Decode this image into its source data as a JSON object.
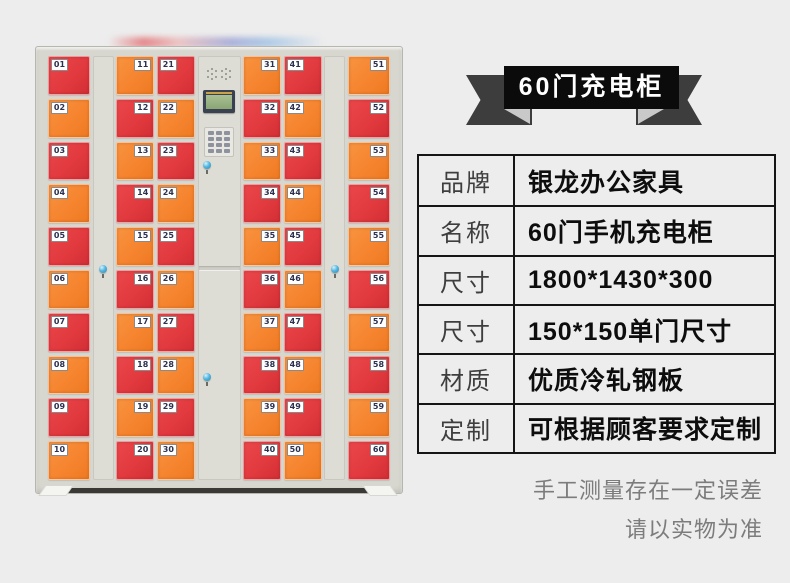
{
  "banner": {
    "title": "60门充电柜",
    "bg_color": "#0b0b0b",
    "ribbon_color": "#3d3d3d",
    "text_color": "#ffffff"
  },
  "spec_table": {
    "rows": [
      {
        "label": "品牌",
        "value": "银龙办公家具"
      },
      {
        "label": "名称",
        "value": "60门手机充电柜"
      },
      {
        "label": "尺寸",
        "value": "1800*1430*300"
      },
      {
        "label": "尺寸",
        "value": "150*150单门尺寸"
      },
      {
        "label": "材质",
        "value": "优质冷轧钢板"
      },
      {
        "label": "定制",
        "value": "可根据顾客要求定制"
      }
    ]
  },
  "disclaimer": {
    "line1": "手工测量存在一定误差",
    "line2": "请以实物为准"
  },
  "cabinet": {
    "door_colors": {
      "red": "#e23a3e",
      "orange": "#f6842f"
    },
    "frame_color": "#d8d7cf",
    "control_panel_features": [
      "speaker-grille",
      "lcd-screen",
      "keypad",
      "lock"
    ],
    "columns": [
      {
        "type": "doors",
        "label_side": "left",
        "doors": [
          {
            "num": "01",
            "color": "red"
          },
          {
            "num": "02",
            "color": "orange"
          },
          {
            "num": "03",
            "color": "red"
          },
          {
            "num": "04",
            "color": "orange"
          },
          {
            "num": "05",
            "color": "red"
          },
          {
            "num": "06",
            "color": "orange"
          },
          {
            "num": "07",
            "color": "red"
          },
          {
            "num": "08",
            "color": "orange"
          },
          {
            "num": "09",
            "color": "red"
          },
          {
            "num": "10",
            "color": "orange"
          }
        ]
      },
      {
        "type": "side-panel"
      },
      {
        "type": "doors",
        "label_side": "right",
        "doors": [
          {
            "num": "11",
            "color": "orange"
          },
          {
            "num": "12",
            "color": "red"
          },
          {
            "num": "13",
            "color": "orange"
          },
          {
            "num": "14",
            "color": "red"
          },
          {
            "num": "15",
            "color": "orange"
          },
          {
            "num": "16",
            "color": "red"
          },
          {
            "num": "17",
            "color": "orange"
          },
          {
            "num": "18",
            "color": "red"
          },
          {
            "num": "19",
            "color": "orange"
          },
          {
            "num": "20",
            "color": "red"
          }
        ]
      },
      {
        "type": "doors",
        "label_side": "left",
        "doors": [
          {
            "num": "21",
            "color": "red"
          },
          {
            "num": "22",
            "color": "orange"
          },
          {
            "num": "23",
            "color": "red"
          },
          {
            "num": "24",
            "color": "orange"
          },
          {
            "num": "25",
            "color": "red"
          },
          {
            "num": "26",
            "color": "orange"
          },
          {
            "num": "27",
            "color": "red"
          },
          {
            "num": "28",
            "color": "orange"
          },
          {
            "num": "29",
            "color": "red"
          },
          {
            "num": "30",
            "color": "orange"
          }
        ]
      },
      {
        "type": "control-panel"
      },
      {
        "type": "doors",
        "label_side": "right",
        "doors": [
          {
            "num": "31",
            "color": "orange"
          },
          {
            "num": "32",
            "color": "red"
          },
          {
            "num": "33",
            "color": "orange"
          },
          {
            "num": "34",
            "color": "red"
          },
          {
            "num": "35",
            "color": "orange"
          },
          {
            "num": "36",
            "color": "red"
          },
          {
            "num": "37",
            "color": "orange"
          },
          {
            "num": "38",
            "color": "red"
          },
          {
            "num": "39",
            "color": "orange"
          },
          {
            "num": "40",
            "color": "red"
          }
        ]
      },
      {
        "type": "doors",
        "label_side": "left",
        "doors": [
          {
            "num": "41",
            "color": "red"
          },
          {
            "num": "42",
            "color": "orange"
          },
          {
            "num": "43",
            "color": "red"
          },
          {
            "num": "44",
            "color": "orange"
          },
          {
            "num": "45",
            "color": "red"
          },
          {
            "num": "46",
            "color": "orange"
          },
          {
            "num": "47",
            "color": "red"
          },
          {
            "num": "48",
            "color": "orange"
          },
          {
            "num": "49",
            "color": "red"
          },
          {
            "num": "50",
            "color": "orange"
          }
        ]
      },
      {
        "type": "side-panel"
      },
      {
        "type": "doors",
        "label_side": "right",
        "doors": [
          {
            "num": "51",
            "color": "orange"
          },
          {
            "num": "52",
            "color": "red"
          },
          {
            "num": "53",
            "color": "orange"
          },
          {
            "num": "54",
            "color": "red"
          },
          {
            "num": "55",
            "color": "orange"
          },
          {
            "num": "56",
            "color": "red"
          },
          {
            "num": "57",
            "color": "orange"
          },
          {
            "num": "58",
            "color": "red"
          },
          {
            "num": "59",
            "color": "orange"
          },
          {
            "num": "60",
            "color": "red"
          }
        ]
      }
    ]
  }
}
